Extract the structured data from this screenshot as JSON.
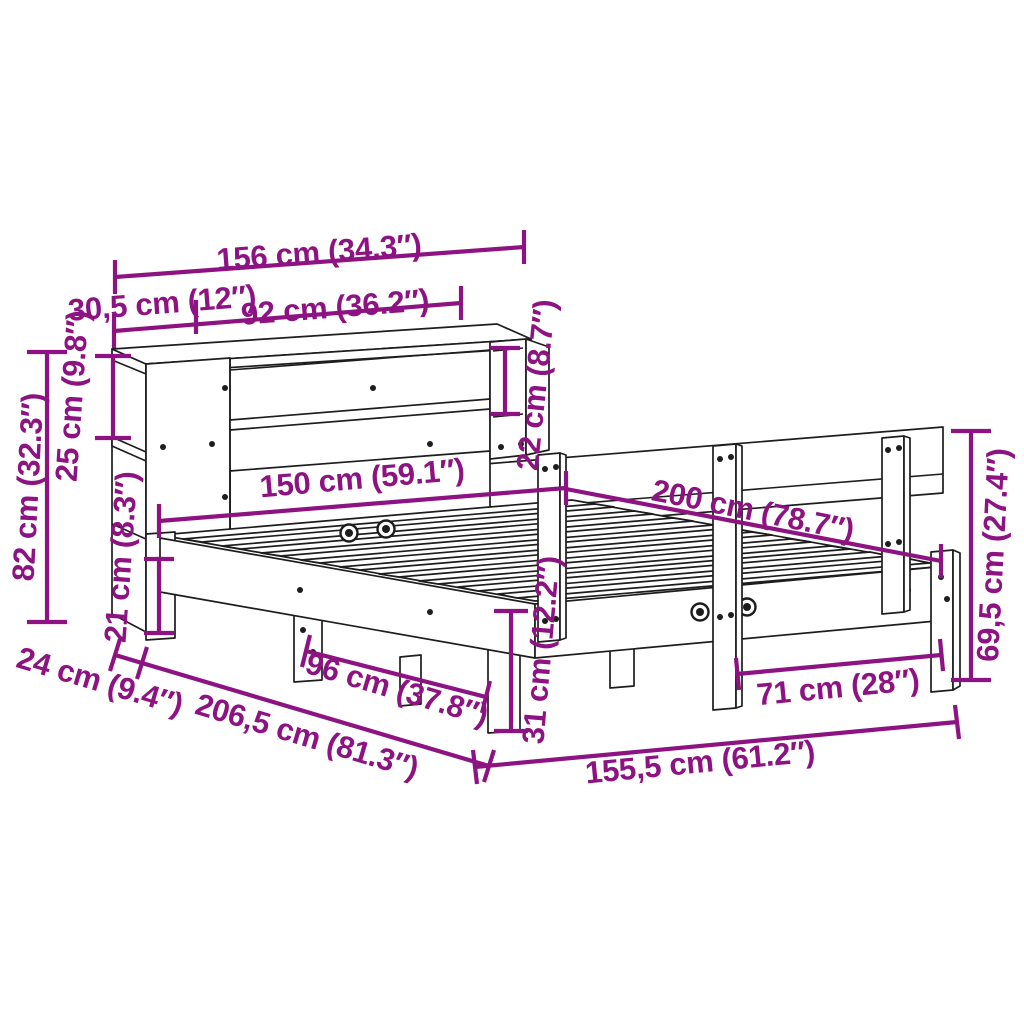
{
  "diagram": {
    "accent_color": "#8E1382",
    "outline_color": "#1d1d1d",
    "background_color": "#ffffff",
    "dimensions": {
      "total_width_top": {
        "label": "156 cm (34.3″)"
      },
      "side_shelf_width": {
        "label": "30,5 cm (12″)"
      },
      "middle_shelf_width": {
        "label": "92 cm (36.2″)"
      },
      "right_shelf_height": {
        "label": "22 cm (8.7″)"
      },
      "top_shelf_height": {
        "label": "25 cm (9.8″)"
      },
      "headboard_height": {
        "label": "82 cm (32.3″)"
      },
      "clearance_height": {
        "label": "21 cm (8.3″)"
      },
      "bed_width": {
        "label": "150 cm (59.1″)"
      },
      "bed_length": {
        "label": "200 cm (78.7″)"
      },
      "rail_height": {
        "label": "69,5 cm (27.4″)"
      },
      "frame_height": {
        "label": "31 cm (12.2″)"
      },
      "base_offset_depth": {
        "label": "24 cm (9.4″)"
      },
      "total_length": {
        "label": "206,5 cm (81.3″)"
      },
      "front_leg_span": {
        "label": "96 cm (37.8″)"
      },
      "side_leg_span": {
        "label": "71 cm (28″)"
      },
      "frame_length": {
        "label": "155,5 cm (61.2″)"
      }
    }
  }
}
